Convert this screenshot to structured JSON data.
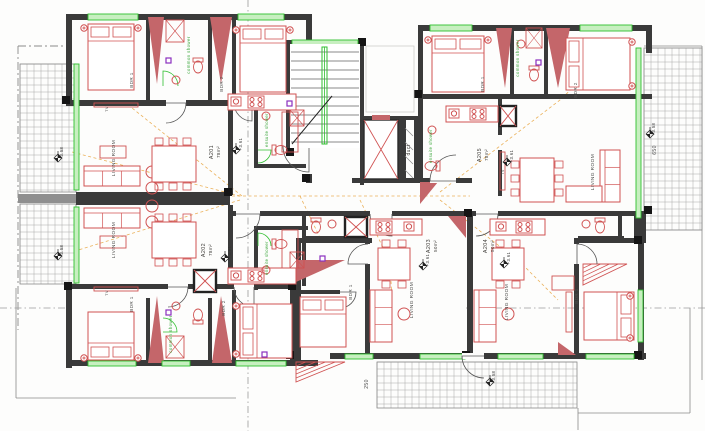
{
  "title": "Second floor apartment plan",
  "colors": {
    "wall": "#3a3a3a",
    "wall_light": "#8f8f8f",
    "wall_red": "#c4666a",
    "furniture_red": "#d05252",
    "window_green": "#2fbf2f",
    "window_green_light": "#c7efc0",
    "shower_label_green": "#3aa53a",
    "room_label_gray": "#50504e",
    "apartment_label": "#403e3a",
    "cable_orange": "#e8a33d",
    "terrace_line": "#a8a8a8",
    "boundary_gray": "#8a8a8a",
    "socket_purple": "#8a2fbf",
    "steel_gray": "#6d6d6d"
  },
  "labels": {
    "bdr1": "BDR 1",
    "bdr2": "BDR 2",
    "living_room": "LIVING ROOM",
    "tv": "TV",
    "common_shower": "common shower",
    "ensuite_shower": "ensuite shower",
    "duct": "duct",
    "dim_250": "250",
    "dim_650": "650",
    "terrace_level": "+3.58"
  },
  "apartments": [
    {
      "id": "A201",
      "area": "78m²",
      "level": "+3.61"
    },
    {
      "id": "A202",
      "area": "78m²",
      "level": "+3.61"
    },
    {
      "id": "A203",
      "area": "50m²",
      "level": "+3.61"
    },
    {
      "id": "A204",
      "area": "50m²",
      "level": "+3.61"
    },
    {
      "id": "A205",
      "area": "78m²",
      "level": "+3.61"
    }
  ]
}
